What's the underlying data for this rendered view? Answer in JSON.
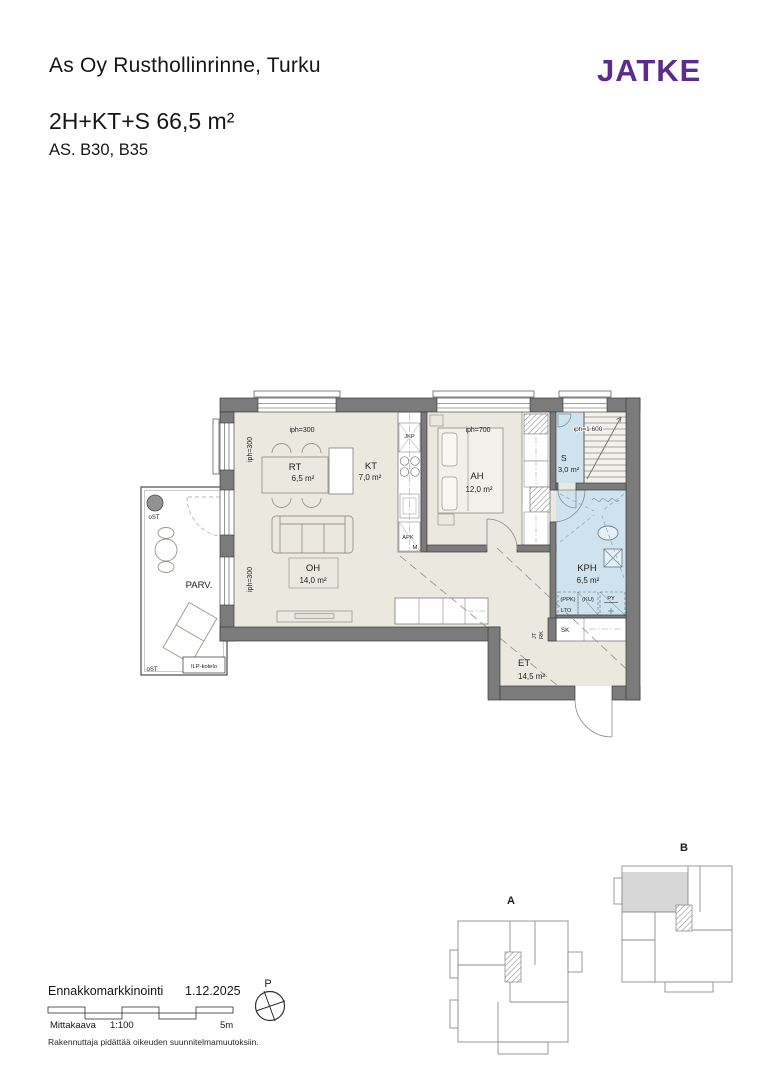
{
  "header": {
    "title": "As Oy Rusthollinrinne, Turku",
    "logo": "JATKE",
    "apartment_type": "2H+KT+S 66,5 m²",
    "apartment_ids": "AS. B30, B35"
  },
  "plan": {
    "rooms": {
      "rt": {
        "name": "RT",
        "area": "6,5 m²"
      },
      "kt": {
        "name": "KT",
        "area": "7,0 m²"
      },
      "oh": {
        "name": "OH",
        "area": "14,0 m²"
      },
      "ah": {
        "name": "AH",
        "area": "12,0 m²"
      },
      "s": {
        "name": "S",
        "area": "3,0 m²"
      },
      "kph": {
        "name": "KPH",
        "area": "6,5 m²"
      },
      "et": {
        "name": "ET",
        "area": "14,5 m²"
      },
      "parv": {
        "name": "PARV."
      }
    },
    "heights": {
      "rt_top": "iph=300",
      "rt_left": "iph=300",
      "oh_left": "iph=300",
      "ah_top": "iph=700",
      "stair_top": "iph=1 600"
    },
    "fixtures": {
      "jkp": "JKP",
      "apk": "APK",
      "m": "M",
      "ppk": "(PPK)",
      "ku": "(KU)",
      "lto": "LTO",
      "py": "PY",
      "sk": "SK",
      "jt": "JT",
      "rk": "RK",
      "ost_top": "oST",
      "ost_bottom": "oST",
      "ilp": "ILP-kotelo"
    }
  },
  "keyplans": {
    "a": "A",
    "b": "B"
  },
  "footer": {
    "marketing_label": "Ennakkomarkkinointi",
    "date": "1.12.2025",
    "scale_label": "Mittakaava",
    "scale_ratio": "1:100",
    "scale_length": "5m",
    "north": "P",
    "disclaimer": "Rakennuttaja pidättää oikeuden suunnitelmamuutoksiin."
  },
  "colors": {
    "logo_purple": "#5b2b8f",
    "wall_gray": "#7b7b7b",
    "floor_beige": "#ebe8e0",
    "wet_blue": "#cfe3ee",
    "keyplan_highlight": "#d7d7d7"
  }
}
